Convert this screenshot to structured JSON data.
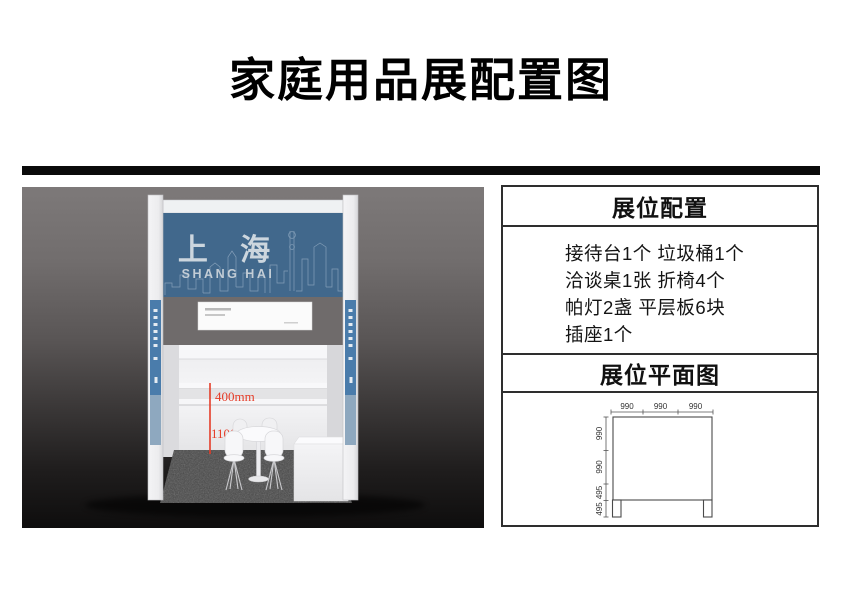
{
  "title": "家庭用品展配置图",
  "booth": {
    "sign_cn": "上 海",
    "sign_en": "SHANG HAI",
    "dim_shelf_gap": "400mm",
    "dim_floor_height": "1100mm"
  },
  "panel": {
    "config": {
      "title": "展位配置",
      "items": [
        "接待台1个 垃圾桶1个",
        "洽谈桌1张 折椅4个",
        "帕灯2盏 平层板6块",
        "插座1个"
      ]
    },
    "plan": {
      "title": "展位平面图",
      "top_dims": [
        "990",
        "990",
        "990"
      ],
      "left_dims": [
        "990",
        "990",
        "495",
        "495"
      ]
    }
  },
  "colors": {
    "fascia_blue": "#41688c",
    "strip_blue": "#4a7cab",
    "accent_red": "#e53c28",
    "carpet_gray": "#4a4a4a"
  }
}
